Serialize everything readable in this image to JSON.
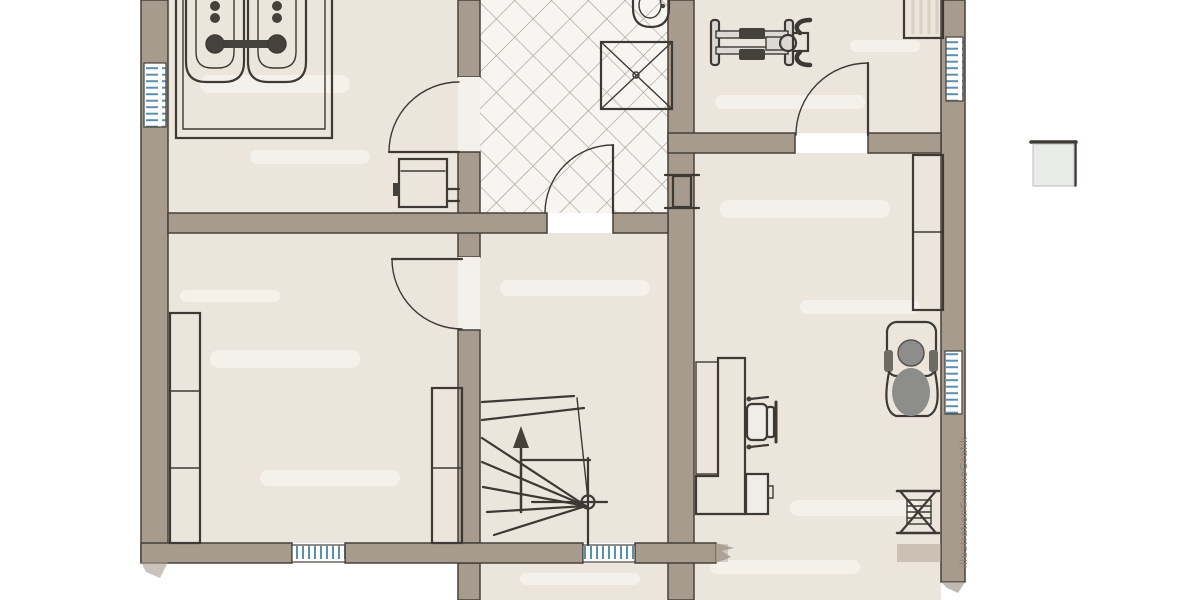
{
  "watermark": {
    "text": "illustration©immoGrafik"
  },
  "palette": {
    "outside": "#ffffff",
    "wall_fill": "#a79b8e",
    "wall_edge": "#46413b",
    "outline": "#3d3935",
    "floor_fill": "#ece5db",
    "hall_tile_bg": "#f7f5f1",
    "tile_line": "#a59e94",
    "window_blue": "#5990af",
    "boiler_blue": "#3c49cd",
    "desk_brown": "#c07b33",
    "wardrobe_brown": "#7b3b1c",
    "chair_yellow": "#e2a820",
    "person_gray": "#8d8d8b",
    "plant_green": "#85b291",
    "sideboard_gray": "#c6cbc8",
    "tank_gray": "#ccd2cf",
    "tank_body": "#f1efec",
    "metal_dark": "#45423c",
    "paper_white": "#fbfaf8",
    "legend_fill": "#e9ebe8",
    "watermark_gray": "#8b8174"
  }
}
